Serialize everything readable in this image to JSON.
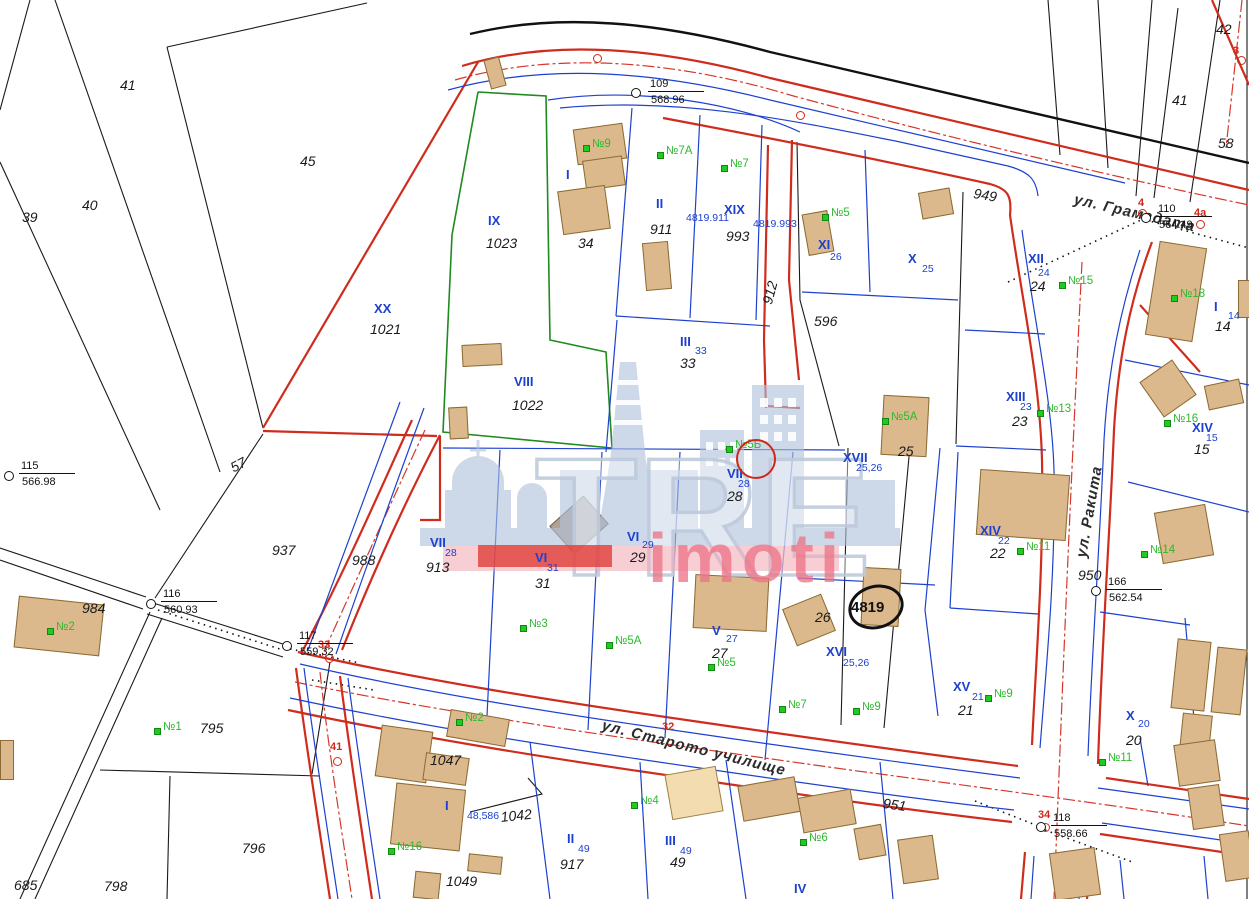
{
  "map": {
    "watermark": {
      "brand": "TRE",
      "sub": "imoti"
    },
    "streets": [
      {
        "t": "ул. Грамадата",
        "x": 1076,
        "y": 192,
        "r": 13
      },
      {
        "t": "ул. Ракита",
        "x": 1074,
        "y": 556,
        "r": -80
      },
      {
        "t": "ул. Старото училище",
        "x": 604,
        "y": 718,
        "r": 14
      }
    ],
    "plan_numbers": [
      {
        "t": "41",
        "x": 120,
        "y": 78
      },
      {
        "t": "45",
        "x": 300,
        "y": 154
      },
      {
        "t": "39",
        "x": 22,
        "y": 210
      },
      {
        "t": "40",
        "x": 82,
        "y": 198
      },
      {
        "t": "57",
        "x": 228,
        "y": 462,
        "r": -28
      },
      {
        "t": "937",
        "x": 272,
        "y": 543
      },
      {
        "t": "984",
        "x": 82,
        "y": 601
      },
      {
        "t": "988",
        "x": 352,
        "y": 553
      },
      {
        "t": "795",
        "x": 200,
        "y": 721
      },
      {
        "t": "796",
        "x": 242,
        "y": 841
      },
      {
        "t": "798",
        "x": 104,
        "y": 879
      },
      {
        "t": "685",
        "x": 14,
        "y": 878
      },
      {
        "t": "1047",
        "x": 430,
        "y": 753
      },
      {
        "t": "1042",
        "x": 500,
        "y": 810,
        "r": -6
      },
      {
        "t": "1049",
        "x": 446,
        "y": 874
      },
      {
        "t": "1023",
        "x": 486,
        "y": 236
      },
      {
        "t": "1021",
        "x": 370,
        "y": 322
      },
      {
        "t": "1022",
        "x": 512,
        "y": 398
      },
      {
        "t": "34",
        "x": 578,
        "y": 236
      },
      {
        "t": "911",
        "x": 650,
        "y": 222
      },
      {
        "t": "993",
        "x": 726,
        "y": 229
      },
      {
        "t": "912",
        "x": 760,
        "y": 302,
        "r": -75
      },
      {
        "t": "596",
        "x": 814,
        "y": 314
      },
      {
        "t": "949",
        "x": 975,
        "y": 186,
        "r": 10
      },
      {
        "t": "950",
        "x": 1078,
        "y": 568
      },
      {
        "t": "951",
        "x": 884,
        "y": 796,
        "r": 8
      },
      {
        "t": "913",
        "x": 426,
        "y": 560
      },
      {
        "t": "24",
        "x": 1030,
        "y": 279
      },
      {
        "t": "23",
        "x": 1012,
        "y": 414
      },
      {
        "t": "33",
        "x": 680,
        "y": 356
      },
      {
        "t": "25",
        "x": 898,
        "y": 444
      },
      {
        "t": "28",
        "x": 727,
        "y": 489
      },
      {
        "t": "31",
        "x": 535,
        "y": 576
      },
      {
        "t": "29",
        "x": 630,
        "y": 550
      },
      {
        "t": "27",
        "x": 712,
        "y": 646
      },
      {
        "t": "26",
        "x": 815,
        "y": 610
      },
      {
        "t": "21",
        "x": 958,
        "y": 703
      },
      {
        "t": "20",
        "x": 1126,
        "y": 733
      },
      {
        "t": "15",
        "x": 1194,
        "y": 442
      },
      {
        "t": "14",
        "x": 1215,
        "y": 319
      },
      {
        "t": "22",
        "x": 990,
        "y": 546
      },
      {
        "t": "49",
        "x": 670,
        "y": 855
      },
      {
        "t": "917",
        "x": 560,
        "y": 857
      },
      {
        "t": "42",
        "x": 1216,
        "y": 22
      },
      {
        "t": "41",
        "x": 1172,
        "y": 93
      },
      {
        "t": "58",
        "x": 1218,
        "y": 136
      }
    ],
    "parcel_romans": [
      {
        "t": "IX",
        "x": 488,
        "y": 214
      },
      {
        "t": "XX",
        "x": 374,
        "y": 302
      },
      {
        "t": "VIII",
        "x": 514,
        "y": 375
      },
      {
        "t": "I",
        "x": 566,
        "y": 168
      },
      {
        "t": "II",
        "x": 656,
        "y": 197
      },
      {
        "t": "XIX",
        "x": 724,
        "y": 203
      },
      {
        "t": "III",
        "x": 680,
        "y": 335
      },
      {
        "t": "XI",
        "x": 818,
        "y": 238
      },
      {
        "t": "X",
        "x": 908,
        "y": 252
      },
      {
        "t": "XII",
        "x": 1028,
        "y": 252
      },
      {
        "t": "XIII",
        "x": 1006,
        "y": 390
      },
      {
        "t": "XIV",
        "x": 1192,
        "y": 421
      },
      {
        "t": "I",
        "x": 1214,
        "y": 300
      },
      {
        "t": "XIV",
        "x": 980,
        "y": 524
      },
      {
        "t": "XVII",
        "x": 843,
        "y": 451
      },
      {
        "t": "VII",
        "x": 727,
        "y": 467
      },
      {
        "t": "VII",
        "x": 430,
        "y": 536
      },
      {
        "t": "VI",
        "x": 535,
        "y": 551
      },
      {
        "t": "VI",
        "x": 627,
        "y": 530
      },
      {
        "t": "V",
        "x": 712,
        "y": 624
      },
      {
        "t": "XVI",
        "x": 826,
        "y": 645
      },
      {
        "t": "XV",
        "x": 953,
        "y": 680
      },
      {
        "t": "X",
        "x": 1126,
        "y": 709
      },
      {
        "t": "I",
        "x": 445,
        "y": 799
      },
      {
        "t": "II",
        "x": 567,
        "y": 832
      },
      {
        "t": "III",
        "x": 665,
        "y": 834
      },
      {
        "t": "IV",
        "x": 794,
        "y": 882
      }
    ],
    "cadastral_numbers": [
      {
        "t": "4819.911",
        "x": 686,
        "y": 213
      },
      {
        "t": "4819.993",
        "x": 753,
        "y": 219
      },
      {
        "t": "26",
        "x": 830,
        "y": 252
      },
      {
        "t": "25",
        "x": 922,
        "y": 264
      },
      {
        "t": "24",
        "x": 1038,
        "y": 268
      },
      {
        "t": "23",
        "x": 1020,
        "y": 402
      },
      {
        "t": "33",
        "x": 695,
        "y": 346
      },
      {
        "t": "15",
        "x": 1206,
        "y": 433
      },
      {
        "t": "14",
        "x": 1228,
        "y": 311
      },
      {
        "t": "22",
        "x": 998,
        "y": 536
      },
      {
        "t": "25,26",
        "x": 856,
        "y": 463
      },
      {
        "t": "28",
        "x": 738,
        "y": 479
      },
      {
        "t": "28",
        "x": 445,
        "y": 548
      },
      {
        "t": "31",
        "x": 547,
        "y": 563
      },
      {
        "t": "29",
        "x": 642,
        "y": 540
      },
      {
        "t": "27",
        "x": 726,
        "y": 634
      },
      {
        "t": "25,26",
        "x": 843,
        "y": 658
      },
      {
        "t": "21",
        "x": 972,
        "y": 692
      },
      {
        "t": "20",
        "x": 1138,
        "y": 719
      },
      {
        "t": "48,586",
        "x": 467,
        "y": 811
      },
      {
        "t": "49",
        "x": 578,
        "y": 844
      },
      {
        "t": "49",
        "x": 680,
        "y": 846
      }
    ],
    "house_numbers": [
      {
        "t": "№9",
        "x": 592,
        "y": 139
      },
      {
        "t": "№7A",
        "x": 666,
        "y": 146
      },
      {
        "t": "№7",
        "x": 730,
        "y": 159
      },
      {
        "t": "№5",
        "x": 831,
        "y": 208
      },
      {
        "t": "№15",
        "x": 1068,
        "y": 276
      },
      {
        "t": "№18",
        "x": 1180,
        "y": 289
      },
      {
        "t": "№13",
        "x": 1046,
        "y": 404
      },
      {
        "t": "№16",
        "x": 1173,
        "y": 414
      },
      {
        "t": "№5A",
        "x": 891,
        "y": 412
      },
      {
        "t": "№11",
        "x": 1026,
        "y": 542
      },
      {
        "t": "№14",
        "x": 1150,
        "y": 545
      },
      {
        "t": "№2",
        "x": 56,
        "y": 622
      },
      {
        "t": "№3",
        "x": 529,
        "y": 619
      },
      {
        "t": "№5A",
        "x": 615,
        "y": 636
      },
      {
        "t": "№5",
        "x": 717,
        "y": 658
      },
      {
        "t": "№7",
        "x": 788,
        "y": 700
      },
      {
        "t": "№9",
        "x": 862,
        "y": 702
      },
      {
        "t": "№9",
        "x": 994,
        "y": 689
      },
      {
        "t": "№11",
        "x": 1108,
        "y": 753
      },
      {
        "t": "№1",
        "x": 163,
        "y": 722
      },
      {
        "t": "№2",
        "x": 465,
        "y": 713
      },
      {
        "t": "№16",
        "x": 397,
        "y": 842
      },
      {
        "t": "№4",
        "x": 640,
        "y": 796
      },
      {
        "t": "№6",
        "x": 809,
        "y": 833
      },
      {
        "t": "№5Б",
        "x": 735,
        "y": 440
      }
    ],
    "red_points": [
      {
        "t": "4",
        "x": 1138,
        "y": 198,
        "cx": 1142,
        "cy": 213
      },
      {
        "t": "4а",
        "x": 1194,
        "y": 208,
        "cx": 1200,
        "cy": 224
      },
      {
        "t": "33",
        "x": 318,
        "y": 640,
        "cx": 329,
        "cy": 658
      },
      {
        "t": "41",
        "x": 330,
        "y": 742,
        "cx": 337,
        "cy": 761
      },
      {
        "t": "32",
        "x": 662,
        "y": 722
      },
      {
        "t": "34",
        "x": 1038,
        "y": 810,
        "cx": 1045,
        "cy": 827
      },
      {
        "t": "3",
        "x": 1233,
        "y": 46,
        "cx": 1241,
        "cy": 60
      },
      {
        "t": "",
        "cx": 597,
        "cy": 58
      },
      {
        "t": "",
        "cx": 800,
        "cy": 115
      }
    ],
    "survey_points": [
      {
        "id": "109",
        "elev": "568.96",
        "cx": 636,
        "cy": 93,
        "lx": 650,
        "ly": 79
      },
      {
        "id": "110",
        "elev": "564.49",
        "cx": 1146,
        "cy": 218,
        "lx": 1158,
        "ly": 204
      },
      {
        "id": "166",
        "elev": "562.54",
        "cx": 1096,
        "cy": 591,
        "lx": 1108,
        "ly": 577
      },
      {
        "id": "115",
        "elev": "566.98",
        "cx": 9,
        "cy": 476,
        "lx": 21,
        "ly": 461
      },
      {
        "id": "116",
        "elev": "560.93",
        "cx": 151,
        "cy": 604,
        "lx": 163,
        "ly": 589
      },
      {
        "id": "117",
        "elev": "559.32",
        "cx": 287,
        "cy": 646,
        "lx": 299,
        "ly": 631
      },
      {
        "id": "118",
        "elev": "558.66",
        "cx": 1041,
        "cy": 827,
        "lx": 1053,
        "ly": 813
      }
    ],
    "highlight": {
      "t": "4819",
      "x": 851,
      "y": 599,
      "ex": 876,
      "ey": 607,
      "rx": 28,
      "ry": 22,
      "rot": -15
    },
    "circled_house": {
      "cx": 756,
      "cy": 459,
      "r": 20
    },
    "buildings": [
      [
        575,
        126,
        50,
        36,
        -8
      ],
      [
        584,
        158,
        40,
        30,
        -8
      ],
      [
        560,
        188,
        48,
        44,
        -8
      ],
      [
        644,
        242,
        26,
        48,
        -5
      ],
      [
        805,
        212,
        26,
        42,
        -10
      ],
      [
        920,
        190,
        32,
        27,
        -10
      ],
      [
        1152,
        244,
        48,
        95,
        9
      ],
      [
        1148,
        367,
        40,
        43,
        -35
      ],
      [
        1206,
        382,
        36,
        25,
        -12
      ],
      [
        882,
        396,
        46,
        60,
        3
      ],
      [
        978,
        472,
        90,
        66,
        4
      ],
      [
        1158,
        508,
        52,
        52,
        -10
      ],
      [
        1174,
        640,
        34,
        70,
        6
      ],
      [
        1180,
        714,
        30,
        56,
        6
      ],
      [
        1214,
        648,
        30,
        66,
        6
      ],
      [
        862,
        568,
        38,
        58,
        3
      ],
      [
        788,
        600,
        42,
        40,
        -22
      ],
      [
        694,
        576,
        74,
        54,
        3
      ],
      [
        462,
        344,
        40,
        22,
        -3
      ],
      [
        449,
        407,
        19,
        32,
        -3
      ],
      [
        16,
        600,
        86,
        52,
        6
      ],
      [
        378,
        728,
        52,
        52,
        8
      ],
      [
        424,
        755,
        44,
        28,
        8
      ],
      [
        448,
        714,
        60,
        28,
        10
      ],
      [
        393,
        786,
        70,
        62,
        6
      ],
      [
        414,
        872,
        26,
        27,
        6
      ],
      [
        468,
        855,
        34,
        18,
        6
      ],
      [
        740,
        781,
        58,
        36,
        -10
      ],
      [
        800,
        793,
        54,
        36,
        -10
      ],
      [
        856,
        826,
        28,
        32,
        -10
      ],
      [
        900,
        837,
        36,
        45,
        -8
      ],
      [
        1052,
        850,
        46,
        48,
        -8
      ],
      [
        1176,
        742,
        42,
        42,
        -8
      ],
      [
        1190,
        786,
        32,
        42,
        -8
      ],
      [
        1222,
        832,
        30,
        48,
        -8
      ],
      [
        0,
        740,
        14,
        40,
        0
      ],
      [
        487,
        58,
        16,
        30,
        -15
      ],
      [
        1238,
        280,
        12,
        38,
        0
      ],
      [
        556,
        506,
        46,
        38,
        -42,
        "g"
      ],
      [
        668,
        770,
        52,
        46,
        -10,
        "l"
      ]
    ],
    "colors": {
      "road_red": "#cf2c1e",
      "line_blue": "#1d41cf",
      "boundary_green": "#1f8a1f",
      "house_green": "#2eb82e",
      "building_fill": "#dcb98c",
      "watermark_pink": "#ee8493",
      "watermark_blue": "#b4c6de"
    }
  }
}
